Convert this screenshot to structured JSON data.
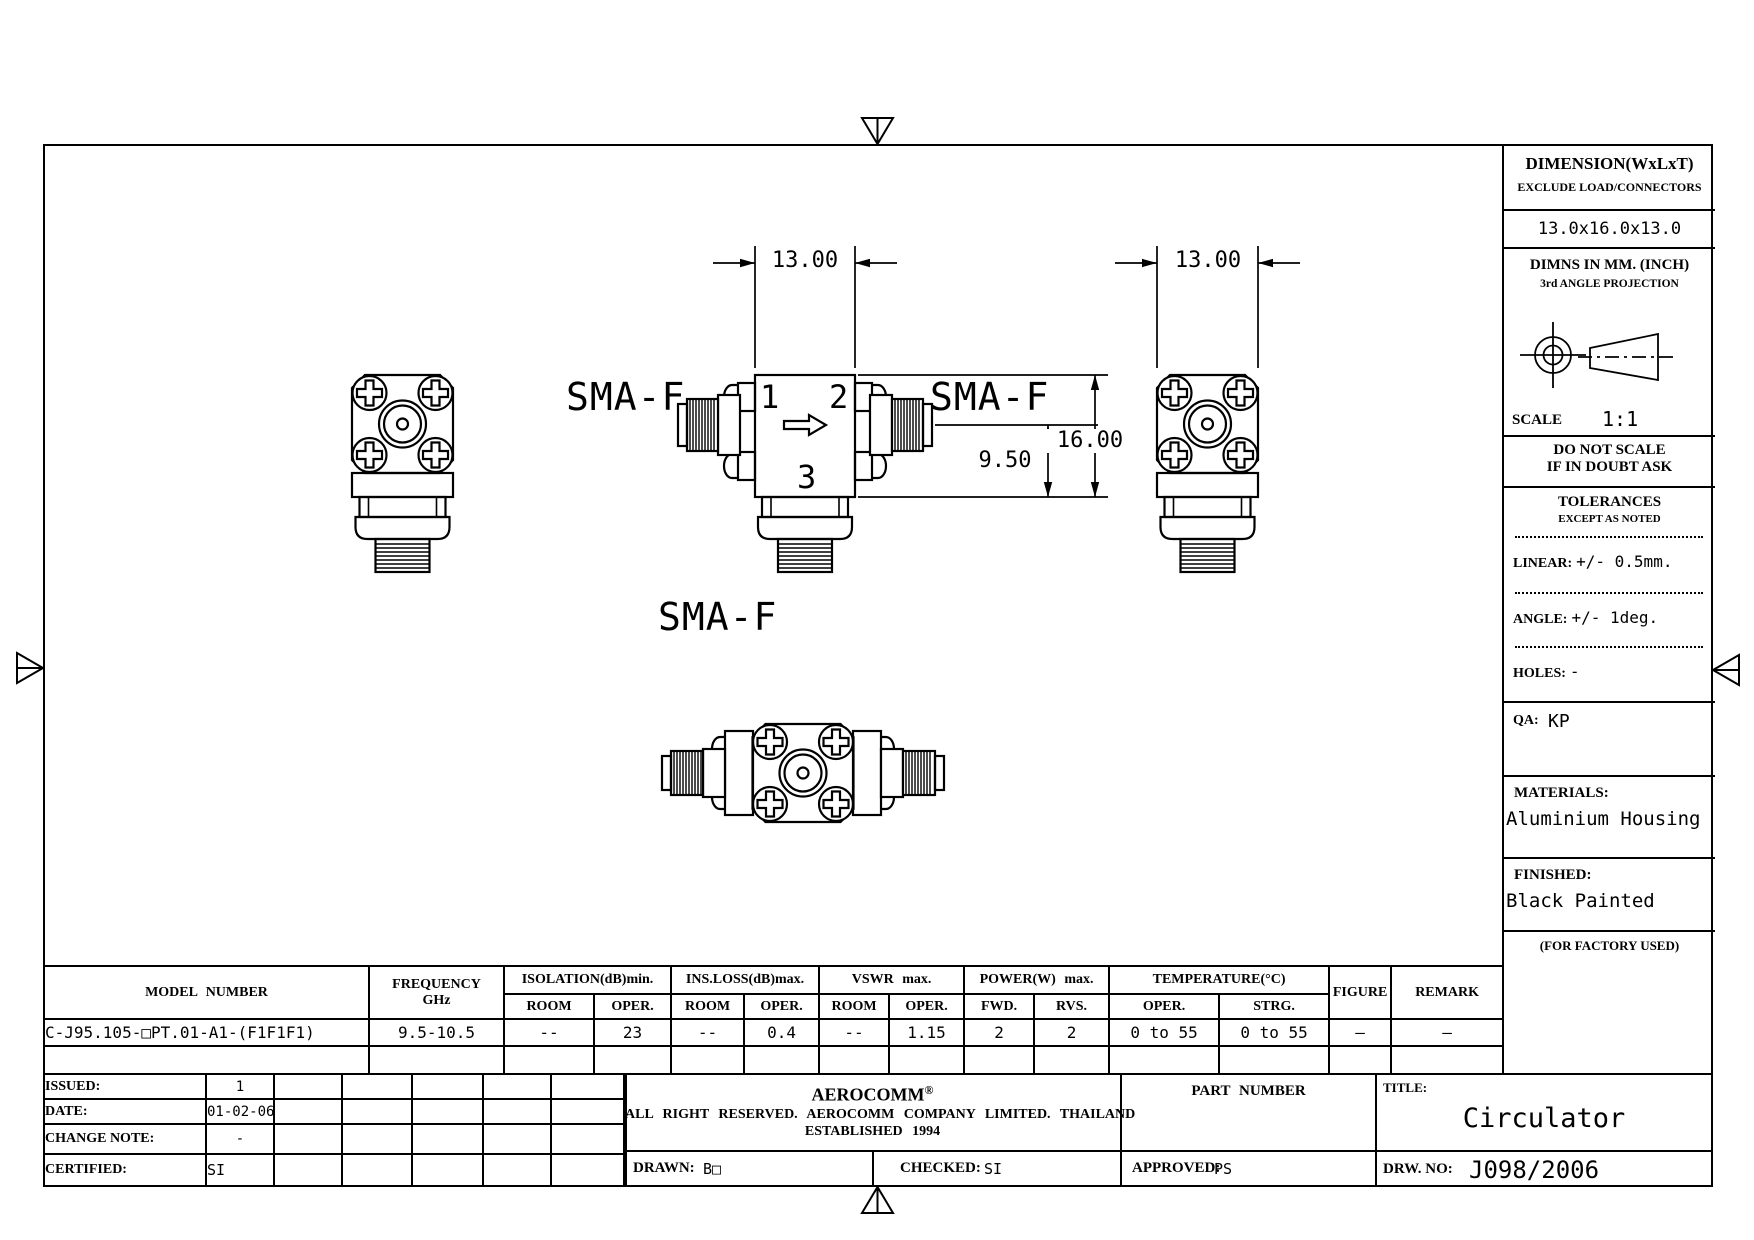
{
  "drawing": {
    "sma_f_left": "SMA-F",
    "sma_f_right": "SMA-F",
    "sma_f_bottom": "SMA-F",
    "port_1": "1",
    "port_2": "2",
    "port_3": "3",
    "dim_width_front": "13.00",
    "dim_width_side": "13.00",
    "dim_height": "16.00",
    "dim_port_height": "9.50"
  },
  "right_panel": {
    "dimension_label": "DIMENSION(WxLxT)",
    "exclude_note": "EXCLUDE LOAD/CONNECTORS",
    "dimension_value": "13.0x16.0x13.0",
    "units_note": "DIMNS IN MM. (INCH)",
    "projection_note": "3rd ANGLE PROJECTION",
    "scale_label": "SCALE",
    "scale_value": "1:1",
    "no_scale_line1": "DO NOT SCALE",
    "no_scale_line2": "IF IN DOUBT ASK",
    "tolerances_title": "TOLERANCES",
    "tolerances_note": "EXCEPT AS NOTED",
    "linear_label": "LINEAR:",
    "linear_value": "+/- 0.5mm.",
    "angle_label": "ANGLE:",
    "angle_value": "+/- 1deg.",
    "holes_label": "HOLES:",
    "holes_value": "-",
    "qa_label": "QA:",
    "qa_value": "KP",
    "materials_label": "MATERIALS:",
    "materials_value": "Aluminium Housing",
    "finished_label": "FINISHED:",
    "finished_value": "Black Painted",
    "factory_note": "(FOR FACTORY USED)"
  },
  "spec_table": {
    "model_number_header": "MODEL NUMBER",
    "frequency_header": "FREQUENCY",
    "frequency_unit": "GHz",
    "isolation_header": "ISOLATION(dB)min.",
    "ins_loss_header": "INS.LOSS(dB)max.",
    "vswr_header": "VSWR max.",
    "power_header": "POWER(W) max.",
    "temperature_header": "TEMPERATURE(°C)",
    "figure_header": "FIGURE",
    "remark_header": "REMARK",
    "sub_headers": [
      "ROOM",
      "OPER.",
      "ROOM",
      "OPER.",
      "ROOM",
      "OPER.",
      "FWD.",
      "RVS.",
      "OPER.",
      "STRG."
    ],
    "row": {
      "model_number": "C-J95.105-□PT.01-A1-(F1F1F1)",
      "frequency": "9.5-10.5",
      "values": [
        "--",
        "23",
        "--",
        "0.4",
        "--",
        "1.15",
        "2",
        "2",
        "0 to 55",
        "0 to 55",
        "—",
        "—"
      ]
    }
  },
  "revision_block": {
    "rows": [
      {
        "label": "ISSUED:",
        "value": "1"
      },
      {
        "label": "DATE:",
        "value": "01-02-06"
      },
      {
        "label": "CHANGE NOTE:",
        "value": "-"
      },
      {
        "label": "CERTIFIED:",
        "value": "SI"
      }
    ]
  },
  "company_block": {
    "name": "AEROCOMM",
    "registered_mark": "®",
    "rights_line": "ALL RIGHT RESERVED. AEROCOMM COMPANY LIMITED. THAILAND",
    "established_line": "ESTABLISHED 1994",
    "drawn_label": "DRAWN:",
    "drawn_value": "B□",
    "checked_label": "CHECKED:",
    "checked_value": "SI",
    "part_number_label": "PART NUMBER",
    "approved_label": "APPROVED:",
    "approved_value": "PS",
    "title_label": "TITLE:",
    "title_value": "Circulator",
    "drw_no_label": "DRW. NO:",
    "drw_no_value": "J098/2006"
  }
}
